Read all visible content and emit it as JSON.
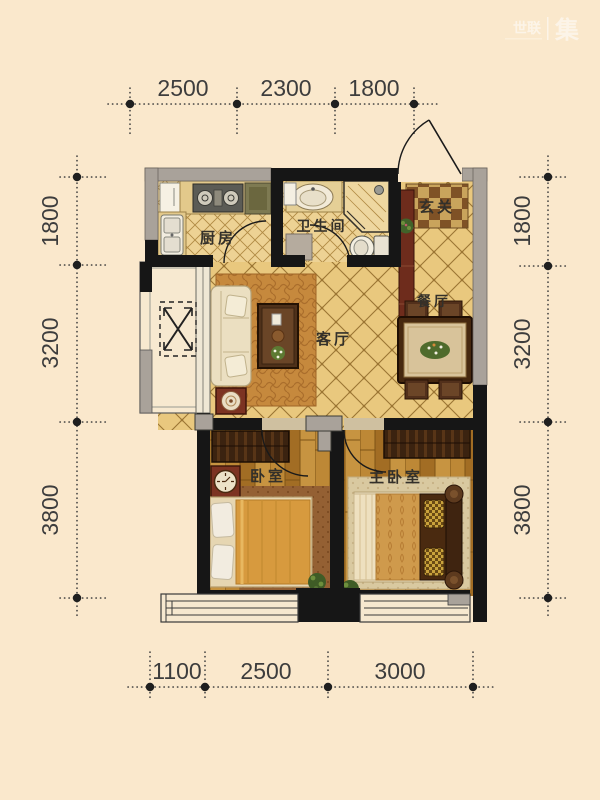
{
  "watermark": {
    "brand_left": "世联",
    "brand_right": "集"
  },
  "rooms": {
    "kitchen": "厨房",
    "bathroom": "卫生间",
    "entry": "玄关",
    "living": "客厅",
    "dining": "餐厅",
    "bedroom": "卧室",
    "master_bedroom": "主卧室"
  },
  "dimensions": {
    "top": [
      "2500",
      "2300",
      "1800"
    ],
    "bottom": [
      "1100",
      "2500",
      "3000"
    ],
    "left": [
      "1800",
      "3200",
      "3800"
    ],
    "right": [
      "1800",
      "3200",
      "3800"
    ]
  },
  "colors": {
    "background": "#fae8cc",
    "wall_solid": "#161616",
    "wall_window_gray": "#a9a29a",
    "tile_floor": "#e9c87e",
    "tile_line": "#9b7533",
    "wood_floor": "#b5802f",
    "dimension_text": "#3d3d3d",
    "cabinet_red": "#6e2c1c",
    "sofa_cream": "#ebdfc1",
    "duvet_orange": "#d79a3e"
  }
}
